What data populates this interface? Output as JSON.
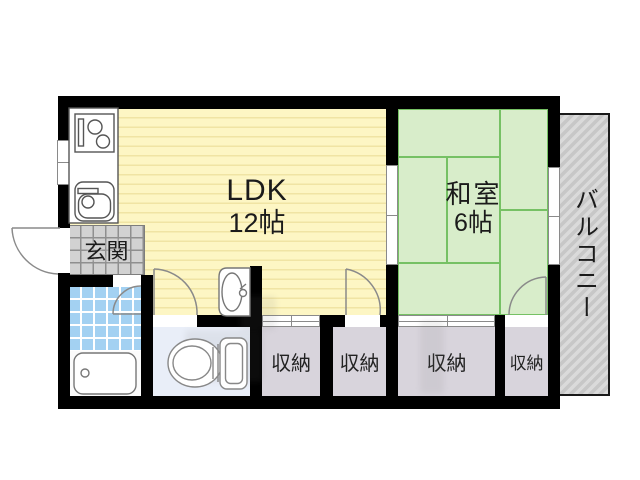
{
  "rooms": {
    "ldk": {
      "name": "LDK",
      "size": "12帖"
    },
    "japanese_room": {
      "name": "和室",
      "size": "6帖"
    },
    "entrance": {
      "label": "玄関"
    },
    "balcony": {
      "label": "バルコニー"
    },
    "closets": [
      {
        "label": "収納"
      },
      {
        "label": "収納"
      },
      {
        "label": "収納"
      },
      {
        "label": "収納"
      }
    ]
  },
  "colors": {
    "wall": "#000000",
    "ldk_floor": "#fdf6c4",
    "ldk_stripe": "#f0e4a4",
    "tatami": "#d8edca",
    "tatami_line": "#76c164",
    "balcony": "#d2d2d2",
    "genkan_tile": "#d2d2d2",
    "bath_tile": "#a3d1f2",
    "toilet_floor": "#e9eef8",
    "closet_floor": "#d8d4dc"
  }
}
